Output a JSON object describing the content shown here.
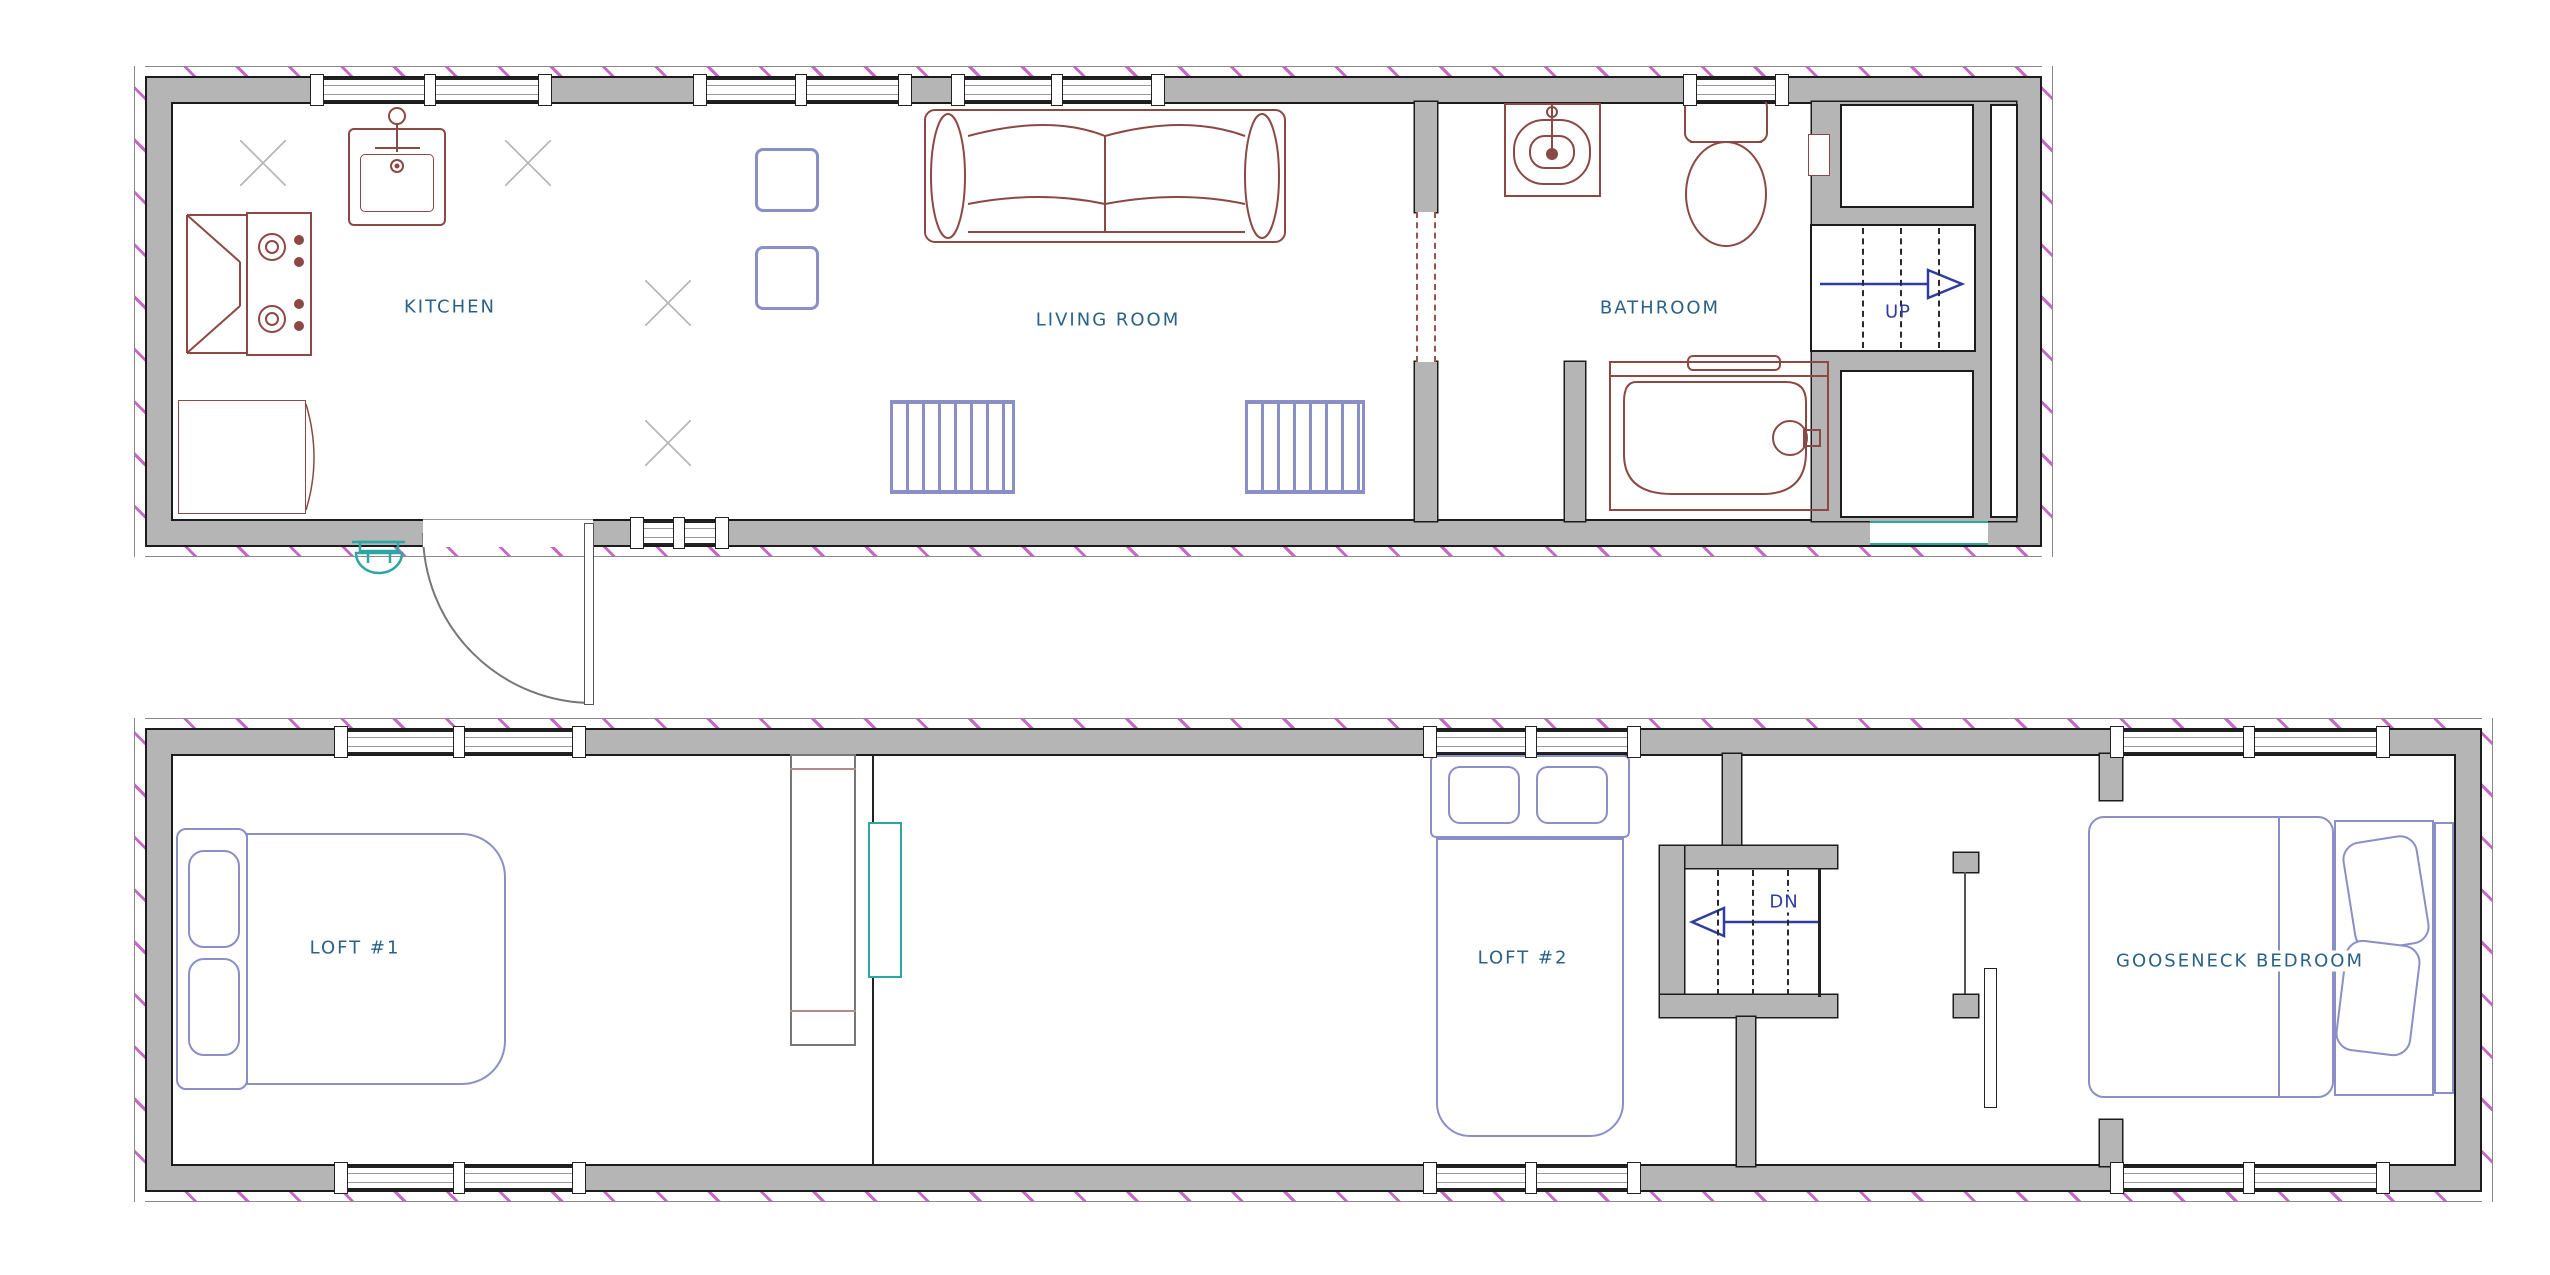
{
  "document": {
    "type": "floor-plan",
    "description": "two-level tiny house plan drawing"
  },
  "colors": {
    "wall_fill": "#b5b5b5",
    "wall_line": "#1c1c1c",
    "exterior_hatch": "#c668c6",
    "room_label": "#2a6187",
    "stair_label": "#2f3d9e",
    "furniture_maroon": "#8c4843",
    "furniture_blue": "#8a8fc8",
    "counter_fill": "#efe6e4",
    "counter_edge": "#9c5350",
    "teal_accent": "#2ca6a4",
    "platform_fill": "#f3f3f3"
  },
  "floor_main": {
    "kitchen_label": "KITCHEN",
    "living_room_label": "LIVING ROOM",
    "bathroom_label": "BATHROOM",
    "stairs_up_label": "UP"
  },
  "floor_loft": {
    "loft1_label": "LOFT #1",
    "loft2_label": "LOFT #2",
    "gooseneck_label": "GOOSENECK BEDROOM",
    "stairs_down_label": "DN"
  }
}
